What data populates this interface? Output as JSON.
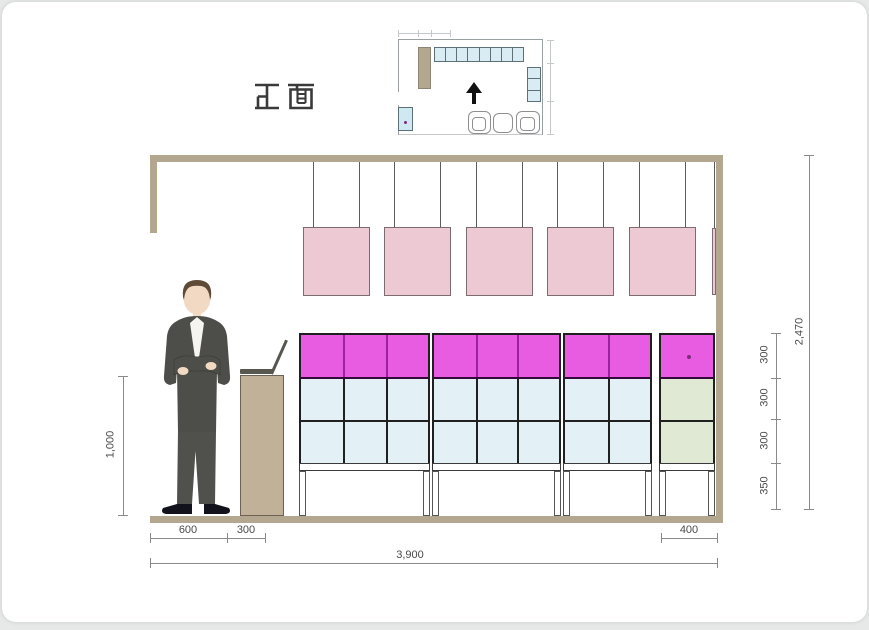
{
  "title": {
    "text": "正面"
  },
  "palette": {
    "magenta": "#e85ce1",
    "magenta_divider": "#9c21a0",
    "light_blue": "#e3f0f5",
    "light_green": "#e0e9d3",
    "panel_pink": "#ecc9d3",
    "wood_tan": "#b3a78f",
    "podium_tan": "#c0b198",
    "plan_blue": "#d9ecf3",
    "suit": "#4d4d49"
  },
  "plan": {
    "top_shelf_cells": 8,
    "right_shelf_cells": 3
  },
  "elevation": {
    "hanging_panels": 5,
    "shelf_units": [
      3,
      3,
      2
    ],
    "right_unit_rows": [
      "magenta",
      "green",
      "green"
    ]
  },
  "dimensions": {
    "left_height": "1,000",
    "bottom_left": "600",
    "bottom_podium": "300",
    "bottom_right_unit": "400",
    "bottom_total": "3,900",
    "shelf_row_1": "300",
    "shelf_row_2": "300",
    "shelf_row_3": "300",
    "shelf_legs": "350",
    "total_height": "2,470"
  }
}
